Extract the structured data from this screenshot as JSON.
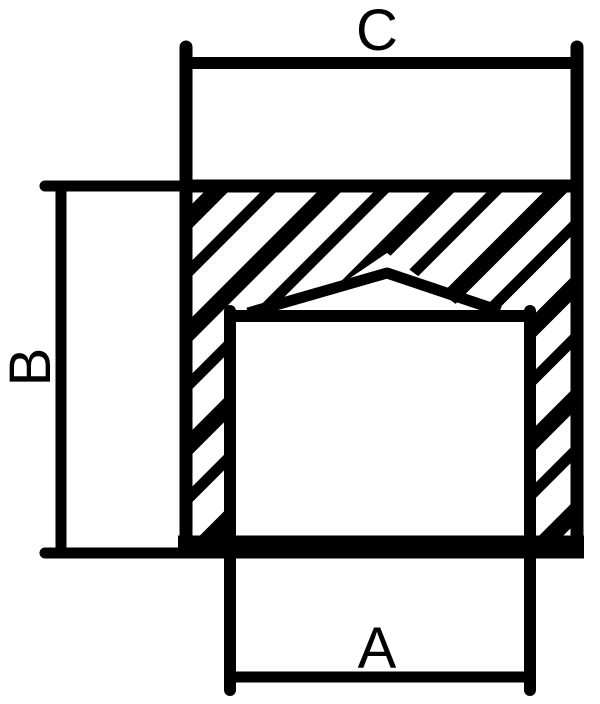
{
  "diagram": {
    "background_color": "#ffffff",
    "line_color": "#000000",
    "labels": {
      "top": "C",
      "left": "B",
      "bottom": "A"
    }
  }
}
